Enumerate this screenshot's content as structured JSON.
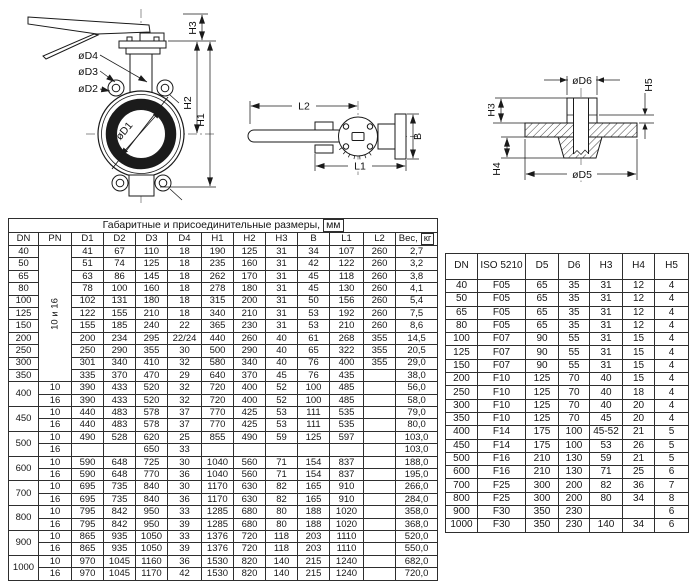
{
  "colors": {
    "line": "#1a1a1a",
    "seat_ring": "#1b1b1b",
    "background": "#ffffff",
    "text": "#111111"
  },
  "drawings": {
    "front_view": {
      "labels": {
        "d4": "øD4",
        "d3": "øD3",
        "d2": "øD2",
        "d1": "øD1",
        "h1": "H1",
        "h2": "H2",
        "h3": "H3"
      }
    },
    "top_view": {
      "labels": {
        "l1": "L1",
        "l2": "L2",
        "b": "B"
      }
    },
    "flange_view": {
      "labels": {
        "d5": "øD5",
        "d6": "øD6",
        "h3": "H3",
        "h4": "H4",
        "h5": "H5"
      }
    }
  },
  "main_table": {
    "title": "Габаритные и присоединительные размеры,",
    "title_unit": "мм",
    "col_headers": [
      "DN",
      "PN",
      "D1",
      "D2",
      "D3",
      "D4",
      "H1",
      "H2",
      "H3",
      "B",
      "L1",
      "L2"
    ],
    "weight_header": "Вес,",
    "weight_unit": "кг",
    "pn_merged_label": "10 и 16",
    "single_rows": [
      [
        "40",
        "41",
        "67",
        "110",
        "18",
        "190",
        "125",
        "31",
        "34",
        "107",
        "260",
        "2,7"
      ],
      [
        "50",
        "51",
        "74",
        "125",
        "18",
        "235",
        "160",
        "31",
        "42",
        "122",
        "260",
        "3,2"
      ],
      [
        "65",
        "63",
        "86",
        "145",
        "18",
        "262",
        "170",
        "31",
        "45",
        "118",
        "260",
        "3,8"
      ],
      [
        "80",
        "78",
        "100",
        "160",
        "18",
        "278",
        "180",
        "31",
        "45",
        "130",
        "260",
        "4,1"
      ],
      [
        "100",
        "102",
        "131",
        "180",
        "18",
        "315",
        "200",
        "31",
        "50",
        "156",
        "260",
        "5,4"
      ],
      [
        "125",
        "122",
        "155",
        "210",
        "18",
        "340",
        "210",
        "31",
        "53",
        "192",
        "260",
        "7,5"
      ],
      [
        "150",
        "155",
        "185",
        "240",
        "22",
        "365",
        "230",
        "31",
        "53",
        "210",
        "260",
        "8,6"
      ],
      [
        "200",
        "200",
        "234",
        "295",
        "22/24",
        "440",
        "260",
        "40",
        "61",
        "268",
        "355",
        "14,5"
      ],
      [
        "250",
        "250",
        "290",
        "355",
        "30",
        "500",
        "290",
        "40",
        "65",
        "322",
        "355",
        "20,5"
      ],
      [
        "300",
        "301",
        "340",
        "410",
        "32",
        "580",
        "340",
        "40",
        "76",
        "400",
        "355",
        "29,0"
      ],
      [
        "350",
        "335",
        "370",
        "470",
        "29",
        "640",
        "370",
        "45",
        "76",
        "435",
        "",
        "38,0"
      ]
    ],
    "double_rows": [
      {
        "dn": "400",
        "sub": [
          [
            "10",
            "390",
            "433",
            "520",
            "32",
            "720",
            "400",
            "52",
            "100",
            "485",
            "",
            "56,0"
          ],
          [
            "16",
            "390",
            "433",
            "520",
            "32",
            "720",
            "400",
            "52",
            "100",
            "485",
            "",
            "58,0"
          ]
        ]
      },
      {
        "dn": "450",
        "sub": [
          [
            "10",
            "440",
            "483",
            "578",
            "37",
            "770",
            "425",
            "53",
            "111",
            "535",
            "",
            "79,0"
          ],
          [
            "16",
            "440",
            "483",
            "578",
            "37",
            "770",
            "425",
            "53",
            "111",
            "535",
            "",
            "80,0"
          ]
        ]
      },
      {
        "dn": "500",
        "sub": [
          [
            "10",
            "490",
            "528",
            "620",
            "25",
            "855",
            "490",
            "59",
            "125",
            "597",
            "",
            "103,0"
          ],
          [
            "16",
            "",
            "",
            "650",
            "33",
            "",
            "",
            "",
            "",
            "",
            "",
            "103,0"
          ]
        ]
      },
      {
        "dn": "600",
        "sub": [
          [
            "10",
            "590",
            "648",
            "725",
            "30",
            "1040",
            "560",
            "71",
            "154",
            "837",
            "",
            "188,0"
          ],
          [
            "16",
            "590",
            "648",
            "770",
            "36",
            "1040",
            "560",
            "71",
            "154",
            "837",
            "",
            "195,0"
          ]
        ]
      },
      {
        "dn": "700",
        "sub": [
          [
            "10",
            "695",
            "735",
            "840",
            "30",
            "1170",
            "630",
            "82",
            "165",
            "910",
            "",
            "266,0"
          ],
          [
            "16",
            "695",
            "735",
            "840",
            "36",
            "1170",
            "630",
            "82",
            "165",
            "910",
            "",
            "284,0"
          ]
        ]
      },
      {
        "dn": "800",
        "sub": [
          [
            "10",
            "795",
            "842",
            "950",
            "33",
            "1285",
            "680",
            "80",
            "188",
            "1020",
            "",
            "358,0"
          ],
          [
            "16",
            "795",
            "842",
            "950",
            "39",
            "1285",
            "680",
            "80",
            "188",
            "1020",
            "",
            "368,0"
          ]
        ]
      },
      {
        "dn": "900",
        "sub": [
          [
            "10",
            "865",
            "935",
            "1050",
            "33",
            "1376",
            "720",
            "118",
            "203",
            "1110",
            "",
            "520,0"
          ],
          [
            "16",
            "865",
            "935",
            "1050",
            "39",
            "1376",
            "720",
            "118",
            "203",
            "1110",
            "",
            "550,0"
          ]
        ]
      },
      {
        "dn": "1000",
        "sub": [
          [
            "10",
            "970",
            "1045",
            "1160",
            "36",
            "1530",
            "820",
            "140",
            "215",
            "1240",
            "",
            "682,0"
          ],
          [
            "16",
            "970",
            "1045",
            "1170",
            "42",
            "1530",
            "820",
            "140",
            "215",
            "1240",
            "",
            "720,0"
          ]
        ]
      }
    ]
  },
  "iso_table": {
    "col_headers": [
      "DN",
      "ISO 5210",
      "D5",
      "D6",
      "H3",
      "H4",
      "H5"
    ],
    "rows": [
      [
        "40",
        "F05",
        "65",
        "35",
        "31",
        "12",
        "4"
      ],
      [
        "50",
        "F05",
        "65",
        "35",
        "31",
        "12",
        "4"
      ],
      [
        "65",
        "F05",
        "65",
        "35",
        "31",
        "12",
        "4"
      ],
      [
        "80",
        "F05",
        "65",
        "35",
        "31",
        "12",
        "4"
      ],
      [
        "100",
        "F07",
        "90",
        "55",
        "31",
        "15",
        "4"
      ],
      [
        "125",
        "F07",
        "90",
        "55",
        "31",
        "15",
        "4"
      ],
      [
        "150",
        "F07",
        "90",
        "55",
        "31",
        "15",
        "4"
      ],
      [
        "200",
        "F10",
        "125",
        "70",
        "40",
        "15",
        "4"
      ],
      [
        "250",
        "F10",
        "125",
        "70",
        "40",
        "18",
        "4"
      ],
      [
        "300",
        "F10",
        "125",
        "70",
        "40",
        "20",
        "4"
      ],
      [
        "350",
        "F10",
        "125",
        "70",
        "45",
        "20",
        "4"
      ],
      [
        "400",
        "F14",
        "175",
        "100",
        "45-52",
        "21",
        "5"
      ],
      [
        "450",
        "F14",
        "175",
        "100",
        "53",
        "26",
        "5"
      ],
      [
        "500",
        "F16",
        "210",
        "130",
        "59",
        "21",
        "5"
      ],
      [
        "600",
        "F16",
        "210",
        "130",
        "71",
        "25",
        "6"
      ],
      [
        "700",
        "F25",
        "300",
        "200",
        "82",
        "36",
        "7"
      ],
      [
        "800",
        "F25",
        "300",
        "200",
        "80",
        "34",
        "8"
      ],
      [
        "900",
        "F30",
        "350",
        "230",
        "",
        "",
        "6"
      ],
      [
        "1000",
        "F30",
        "350",
        "230",
        "140",
        "34",
        "6"
      ]
    ]
  }
}
